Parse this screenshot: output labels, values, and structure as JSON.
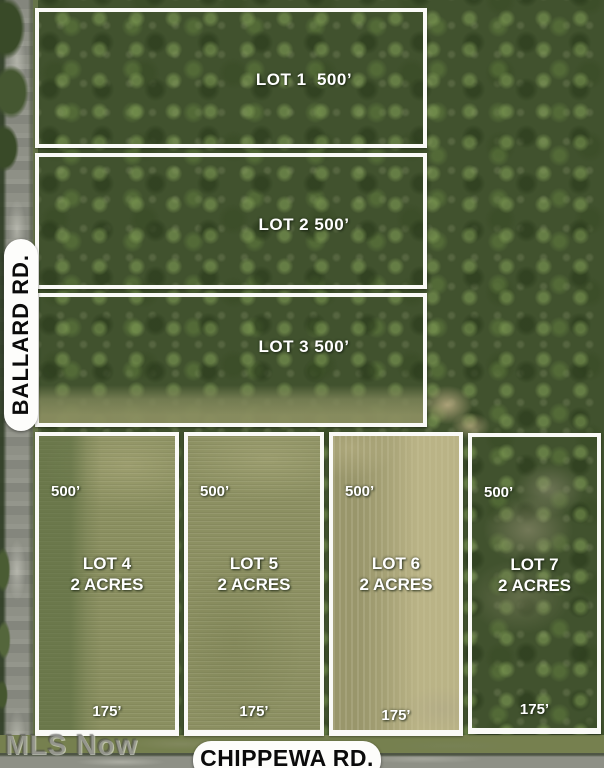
{
  "signs": {
    "ballard": "BALLARD RD.",
    "chippewa": "CHIPPEWA RD."
  },
  "watermark": "MLS Now",
  "top_lots": [
    {
      "id": "lot-1",
      "label": "LOT 1  500’"
    },
    {
      "id": "lot-2",
      "label": "LOT 2 500’"
    },
    {
      "id": "lot-3",
      "label": "LOT 3 500’"
    }
  ],
  "bottom_lots": [
    {
      "id": "lot-4",
      "name": "LOT 4",
      "size": "2 ACRES",
      "depth": "500’",
      "frontage": "175’"
    },
    {
      "id": "lot-5",
      "name": "LOT 5",
      "size": "2 ACRES",
      "depth": "500’",
      "frontage": "175’"
    },
    {
      "id": "lot-6",
      "name": "LOT 6",
      "size": "2 ACRES",
      "depth": "500’",
      "frontage": "175’"
    },
    {
      "id": "lot-7",
      "name": "LOT 7",
      "size": "2 ACRES",
      "depth": "500’",
      "frontage": "175’"
    }
  ],
  "colors": {
    "lot_boundary": "#fafaf7",
    "lot_label_text": "#ffffff",
    "sign_background": "#fdfdfb",
    "sign_text": "#0b0b0b",
    "forest_green": "#41522e",
    "field_olive": "#8e9164",
    "road_gray": "#8e9086"
  }
}
